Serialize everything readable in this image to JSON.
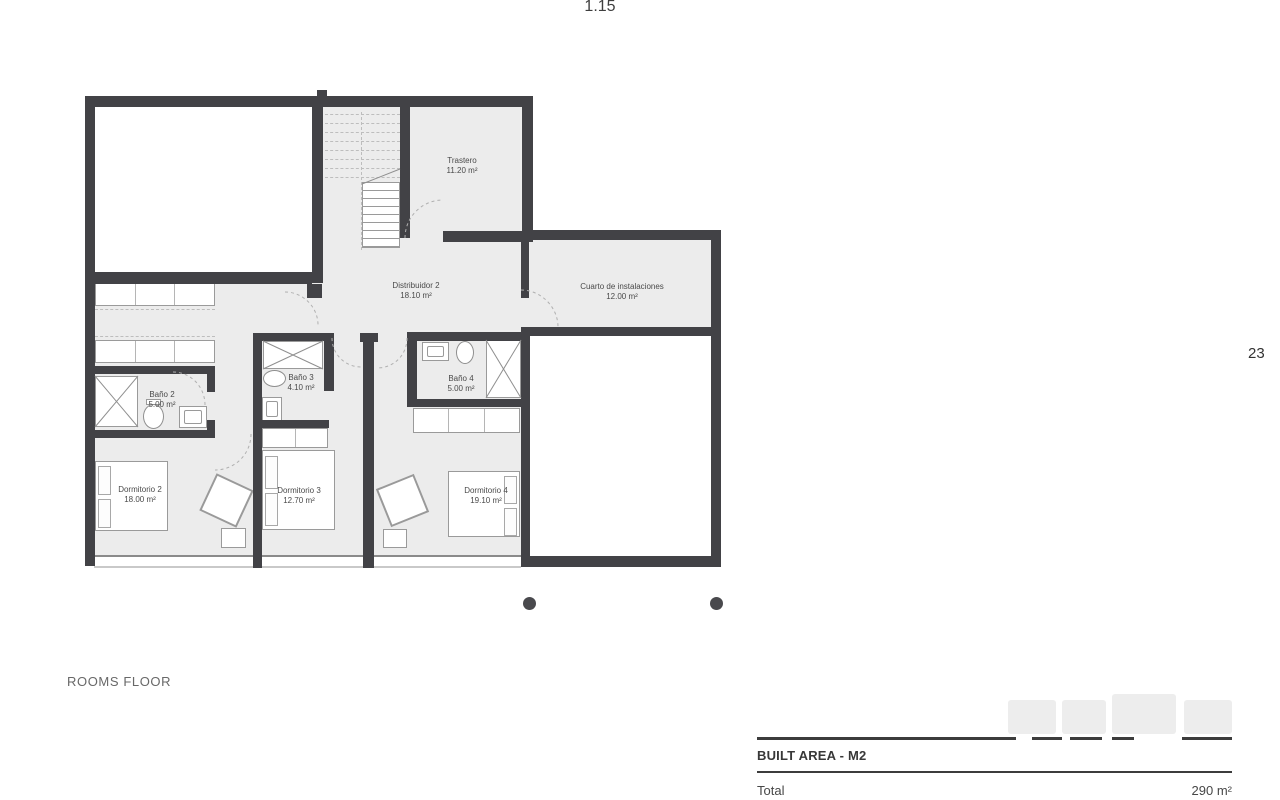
{
  "page": {
    "scale_label": "1.15",
    "page_number": "23",
    "floor_label": "ROOMS FLOOR"
  },
  "rooms": [
    {
      "name": "Trastero",
      "area": "11.20 m²"
    },
    {
      "name": "Distribuidor 2",
      "area": "18.10 m²"
    },
    {
      "name": "Cuarto de instalaciones",
      "area": "12.00 m²"
    },
    {
      "name": "Baño 2",
      "area": "5.00 m²"
    },
    {
      "name": "Baño 3",
      "area": "4.10 m²"
    },
    {
      "name": "Baño 4",
      "area": "5.00 m²"
    },
    {
      "name": "Dormitorio 2",
      "area": "18.00 m²"
    },
    {
      "name": "Dormitorio 3",
      "area": "12.70 m²"
    },
    {
      "name": "Dormitorio 4",
      "area": "19.10 m²"
    }
  ],
  "built_area": {
    "title": "BUILT AREA - M2",
    "rows": [
      {
        "label": "Total",
        "value": "290 m²"
      }
    ]
  },
  "colors": {
    "wall": "#424246",
    "floor": "#ececec",
    "furniture_line": "#9a9a9a",
    "text": "#4a4a4a"
  }
}
